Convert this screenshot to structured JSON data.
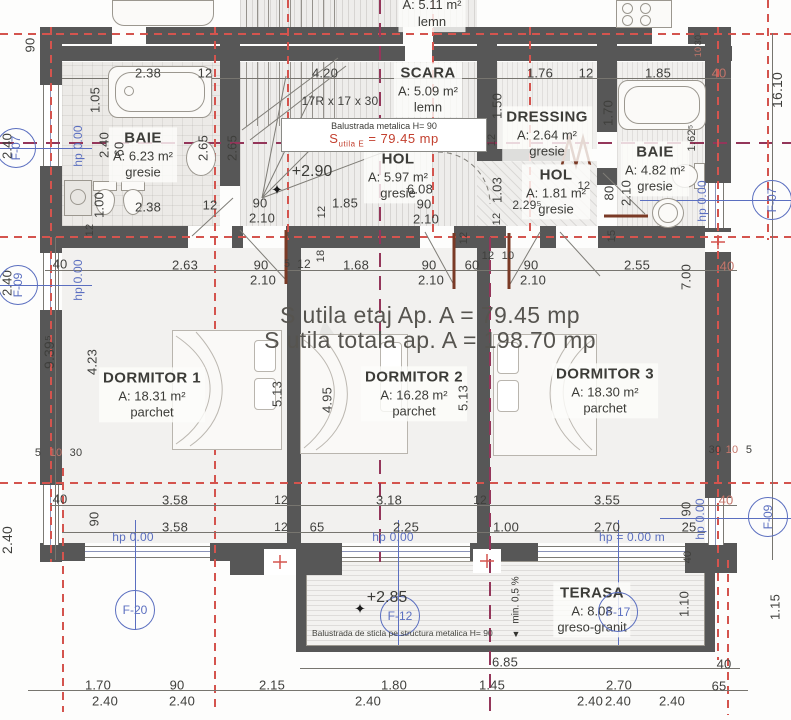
{
  "meta": {
    "drawing_type": "architectural floor plan - etaj"
  },
  "colors": {
    "wall": "#575757",
    "axis_red": "#d4544e",
    "axis_maroon": "#94365a",
    "annotation_blue": "#5b6fc0",
    "door_brown": "#7a3a26",
    "dim_text": "#3f3f3c",
    "red_text": "#c3402f"
  },
  "summary": {
    "line1": "S utila etaj Ap. A = 79.45 mp",
    "line2": "S utila totala ap. A = 198.70 mp"
  },
  "red_note": {
    "prefix": "S",
    "sub": "utila E",
    "value": "= 79.45 mp"
  },
  "notes": {
    "balustrade_metal": "Balustrada metalica H= 90",
    "balustrade_glass": "Balustrada de sticla pe structura metalica H= 90",
    "slope": "min. 0,5 %"
  },
  "rooms": [
    {
      "name": "BAIE",
      "area": "A: 6.23 m²",
      "floor": "gresie",
      "x": 143,
      "y": 155
    },
    {
      "name": "SCARA",
      "area": "A: 5.09 m²",
      "floor": "lemn",
      "x": 428,
      "y": 90
    },
    {
      "name": "HOL",
      "area": "A: 5.97 m²",
      "floor": "gresie",
      "x": 398,
      "y": 176
    },
    {
      "name": "DRESSING",
      "area": "A: 2.64 m²",
      "floor": "gresie",
      "x": 547,
      "y": 134
    },
    {
      "name": "HOL",
      "area": "A: 1.81 m²",
      "floor": "gresie",
      "x": 556,
      "y": 192
    },
    {
      "name": "BAIE",
      "area": "A: 4.82 m²",
      "floor": "gresie",
      "x": 655,
      "y": 169
    },
    {
      "name": "DORMITOR 1",
      "area": "A: 18.31 m²",
      "floor": "parchet",
      "x": 152,
      "y": 395
    },
    {
      "name": "DORMITOR 2",
      "area": "A: 16.28 m²",
      "floor": "parchet",
      "x": 414,
      "y": 394
    },
    {
      "name": "DORMITOR 3",
      "area": "A: 18.30 m²",
      "floor": "parchet",
      "x": 605,
      "y": 391
    },
    {
      "name": "TERASA",
      "area": "A: 8.08",
      "floor": "greso-granit",
      "x": 592,
      "y": 610
    },
    {
      "name": "",
      "area": "A: 5.11 m²",
      "floor": "lemn",
      "x": 432,
      "y": 14
    }
  ],
  "levels": [
    {
      "t": "+2.90",
      "x": 312,
      "y": 172
    },
    {
      "t": "+2.85",
      "x": 387,
      "y": 598
    }
  ],
  "stars": [
    {
      "t": "✦",
      "x": 277,
      "y": 190
    },
    {
      "t": "✦",
      "x": 360,
      "y": 609
    }
  ],
  "markers": [
    {
      "t": "F-07",
      "x": 16,
      "y": 148,
      "r": 1
    },
    {
      "t": "F-09",
      "x": 18,
      "y": 285,
      "r": 1
    },
    {
      "t": "F-07",
      "x": 772,
      "y": 200,
      "r": 1
    },
    {
      "t": "F-09",
      "x": 768,
      "y": 517,
      "r": 1
    },
    {
      "t": "F-20",
      "x": 135,
      "y": 610
    },
    {
      "t": "F-12",
      "x": 400,
      "y": 616
    },
    {
      "t": "F-17",
      "x": 618,
      "y": 612
    }
  ],
  "hp_labels": [
    {
      "t": "hp 0.00",
      "x": 78,
      "y": 146,
      "r": 1
    },
    {
      "t": "hp 0.00",
      "x": 78,
      "y": 280,
      "r": 1
    },
    {
      "t": "hp 0.00",
      "x": 702,
      "y": 201,
      "r": 1
    },
    {
      "t": "hp 0.00",
      "x": 700,
      "y": 519,
      "r": 1
    },
    {
      "t": "hp 0.00",
      "x": 133,
      "y": 537
    },
    {
      "t": "hp 0.00",
      "x": 393,
      "y": 537
    },
    {
      "t": "hp = 0.00 m",
      "x": 632,
      "y": 537
    }
  ],
  "dims": [
    {
      "t": "90",
      "x": 30,
      "y": 45,
      "r": 1
    },
    {
      "t": "2.38",
      "x": 148,
      "y": 73
    },
    {
      "t": "12",
      "x": 205,
      "y": 73
    },
    {
      "t": "4.20",
      "x": 325,
      "y": 73
    },
    {
      "t": "1.76",
      "x": 540,
      "y": 73
    },
    {
      "t": "12",
      "x": 586,
      "y": 73
    },
    {
      "t": "1.85",
      "x": 658,
      "y": 73
    },
    {
      "t": "40",
      "x": 719,
      "y": 73,
      "c": 1
    },
    {
      "t": "16.10",
      "x": 777,
      "y": 90,
      "r": 1,
      "fs": 14
    },
    {
      "t": "30",
      "x": 698,
      "y": 40,
      "r": 1,
      "fs": 9
    },
    {
      "t": "10",
      "x": 698,
      "y": 52,
      "r": 1,
      "fs": 9,
      "c": 1
    },
    {
      "t": "1.05",
      "x": 95,
      "y": 100,
      "r": 1
    },
    {
      "t": "17R x 17 x 30",
      "x": 340,
      "y": 101,
      "fs": 12
    },
    {
      "t": "1.50",
      "x": 497,
      "y": 106,
      "r": 1
    },
    {
      "t": "1.70",
      "x": 608,
      "y": 113,
      "r": 1
    },
    {
      "t": "2.40",
      "x": 104,
      "y": 145,
      "r": 1
    },
    {
      "t": "60",
      "x": 119,
      "y": 149,
      "r": 1
    },
    {
      "t": "2.65",
      "x": 203,
      "y": 148,
      "r": 1
    },
    {
      "t": "2.65",
      "x": 232,
      "y": 148,
      "r": 1
    },
    {
      "t": "1.62⁵",
      "x": 692,
      "y": 138,
      "r": 1,
      "fs": 11
    },
    {
      "t": "12",
      "x": 492,
      "y": 140,
      "r": 1,
      "fs": 11
    },
    {
      "t": "1.00",
      "x": 99,
      "y": 205,
      "r": 1
    },
    {
      "t": "2.38",
      "x": 148,
      "y": 207
    },
    {
      "t": "12",
      "x": 210,
      "y": 205
    },
    {
      "t": "12",
      "x": 90,
      "y": 230,
      "r": 1,
      "fs": 11
    },
    {
      "t": "90",
      "x": 260,
      "y": 203
    },
    {
      "t": "2.10",
      "x": 262,
      "y": 218
    },
    {
      "t": "1.85",
      "x": 345,
      "y": 203
    },
    {
      "t": "12",
      "x": 322,
      "y": 212,
      "r": 1,
      "fs": 11
    },
    {
      "t": "6.08",
      "x": 420,
      "y": 189
    },
    {
      "t": "90",
      "x": 424,
      "y": 204
    },
    {
      "t": "2.10",
      "x": 426,
      "y": 219
    },
    {
      "t": "1.03",
      "x": 497,
      "y": 190,
      "r": 1
    },
    {
      "t": "12",
      "x": 497,
      "y": 219,
      "r": 1,
      "fs": 11
    },
    {
      "t": "2.29⁵",
      "x": 527,
      "y": 205,
      "fs": 12
    },
    {
      "t": "12",
      "x": 584,
      "y": 186,
      "fs": 11
    },
    {
      "t": "80",
      "x": 609,
      "y": 193,
      "r": 1
    },
    {
      "t": "2.10",
      "x": 626,
      "y": 193,
      "r": 1
    },
    {
      "t": "40",
      "x": 60,
      "y": 264
    },
    {
      "t": "2.63",
      "x": 185,
      "y": 265
    },
    {
      "t": "90",
      "x": 261,
      "y": 265
    },
    {
      "t": "2.10",
      "x": 263,
      "y": 280
    },
    {
      "t": "5",
      "x": 287,
      "y": 264,
      "fs": 11
    },
    {
      "t": "12",
      "x": 304,
      "y": 264,
      "fs": 12
    },
    {
      "t": "18",
      "x": 321,
      "y": 256,
      "r": 1,
      "fs": 11
    },
    {
      "t": "1.68",
      "x": 356,
      "y": 265
    },
    {
      "t": "12",
      "x": 464,
      "y": 238,
      "r": 1,
      "fs": 11
    },
    {
      "t": "15",
      "x": 612,
      "y": 236,
      "r": 1,
      "fs": 11
    },
    {
      "t": "90",
      "x": 429,
      "y": 265
    },
    {
      "t": "2.10",
      "x": 431,
      "y": 280
    },
    {
      "t": "60",
      "x": 472,
      "y": 265
    },
    {
      "t": "12",
      "x": 488,
      "y": 256,
      "fs": 11
    },
    {
      "t": "10",
      "x": 508,
      "y": 256,
      "fs": 11
    },
    {
      "t": "90",
      "x": 531,
      "y": 265
    },
    {
      "t": "2.10",
      "x": 533,
      "y": 280
    },
    {
      "t": "2.55",
      "x": 637,
      "y": 265
    },
    {
      "t": "7.00",
      "x": 686,
      "y": 277,
      "r": 1
    },
    {
      "t": "40",
      "x": 727,
      "y": 266,
      "c": 1
    },
    {
      "t": "4.23",
      "x": 92,
      "y": 362,
      "r": 1
    },
    {
      "t": "9.39⁵",
      "x": 49,
      "y": 352,
      "r": 1,
      "fs": 14
    },
    {
      "t": "5.13",
      "x": 277,
      "y": 394,
      "r": 1
    },
    {
      "t": "4.95",
      "x": 327,
      "y": 400,
      "r": 1
    },
    {
      "t": "5.13",
      "x": 463,
      "y": 398,
      "r": 1
    },
    {
      "t": "5",
      "x": 38,
      "y": 453,
      "fs": 11
    },
    {
      "t": "10",
      "x": 56,
      "y": 453,
      "fs": 11,
      "c": 1
    },
    {
      "t": "30",
      "x": 76,
      "y": 453,
      "fs": 11
    },
    {
      "t": "30",
      "x": 715,
      "y": 450,
      "fs": 11
    },
    {
      "t": "10",
      "x": 732,
      "y": 450,
      "fs": 11,
      "c": 1
    },
    {
      "t": "5",
      "x": 749,
      "y": 450,
      "fs": 11
    },
    {
      "t": "40",
      "x": 60,
      "y": 499
    },
    {
      "t": "3.58",
      "x": 175,
      "y": 500
    },
    {
      "t": "12",
      "x": 281,
      "y": 500,
      "fs": 12
    },
    {
      "t": "3.18",
      "x": 389,
      "y": 500
    },
    {
      "t": "12",
      "x": 480,
      "y": 500,
      "fs": 12
    },
    {
      "t": "3.55",
      "x": 607,
      "y": 500
    },
    {
      "t": "40",
      "x": 726,
      "y": 500,
      "c": 1
    },
    {
      "t": "90",
      "x": 94,
      "y": 519,
      "r": 1
    },
    {
      "t": "3.58",
      "x": 175,
      "y": 527
    },
    {
      "t": "12",
      "x": 281,
      "y": 527,
      "fs": 12
    },
    {
      "t": "65",
      "x": 317,
      "y": 527
    },
    {
      "t": "2.25",
      "x": 406,
      "y": 527
    },
    {
      "t": "1.00",
      "x": 506,
      "y": 527
    },
    {
      "t": "2.70",
      "x": 607,
      "y": 527
    },
    {
      "t": "25",
      "x": 689,
      "y": 527
    },
    {
      "t": "90",
      "x": 686,
      "y": 509,
      "r": 1
    },
    {
      "t": "40",
      "x": 688,
      "y": 557,
      "r": 1,
      "fs": 11
    },
    {
      "t": "1.10",
      "x": 684,
      "y": 604,
      "r": 1
    },
    {
      "t": "1.15",
      "x": 775,
      "y": 607,
      "r": 1
    },
    {
      "t": "6.85",
      "x": 505,
      "y": 662
    },
    {
      "t": "40",
      "x": 724,
      "y": 664
    },
    {
      "t": "65",
      "x": 719,
      "y": 686
    },
    {
      "t": "1.70",
      "x": 98,
      "y": 685
    },
    {
      "t": "90",
      "x": 177,
      "y": 685
    },
    {
      "t": "2.15",
      "x": 272,
      "y": 685
    },
    {
      "t": "1.80",
      "x": 394,
      "y": 685
    },
    {
      "t": "1.45",
      "x": 492,
      "y": 685
    },
    {
      "t": "2.70",
      "x": 619,
      "y": 685
    },
    {
      "t": "2.40",
      "x": 105,
      "y": 701
    },
    {
      "t": "2.40",
      "x": 182,
      "y": 701
    },
    {
      "t": "2.40",
      "x": 368,
      "y": 701
    },
    {
      "t": "2.40",
      "x": 590,
      "y": 701
    },
    {
      "t": "2.40",
      "x": 618,
      "y": 701
    },
    {
      "t": "2.40",
      "x": 672,
      "y": 701
    },
    {
      "t": "2.40",
      "x": 7,
      "y": 146,
      "r": 1
    },
    {
      "t": "2.40",
      "x": 7,
      "y": 283,
      "r": 1
    },
    {
      "t": "2.40",
      "x": 7,
      "y": 540,
      "r": 1,
      "fs": 14
    }
  ]
}
